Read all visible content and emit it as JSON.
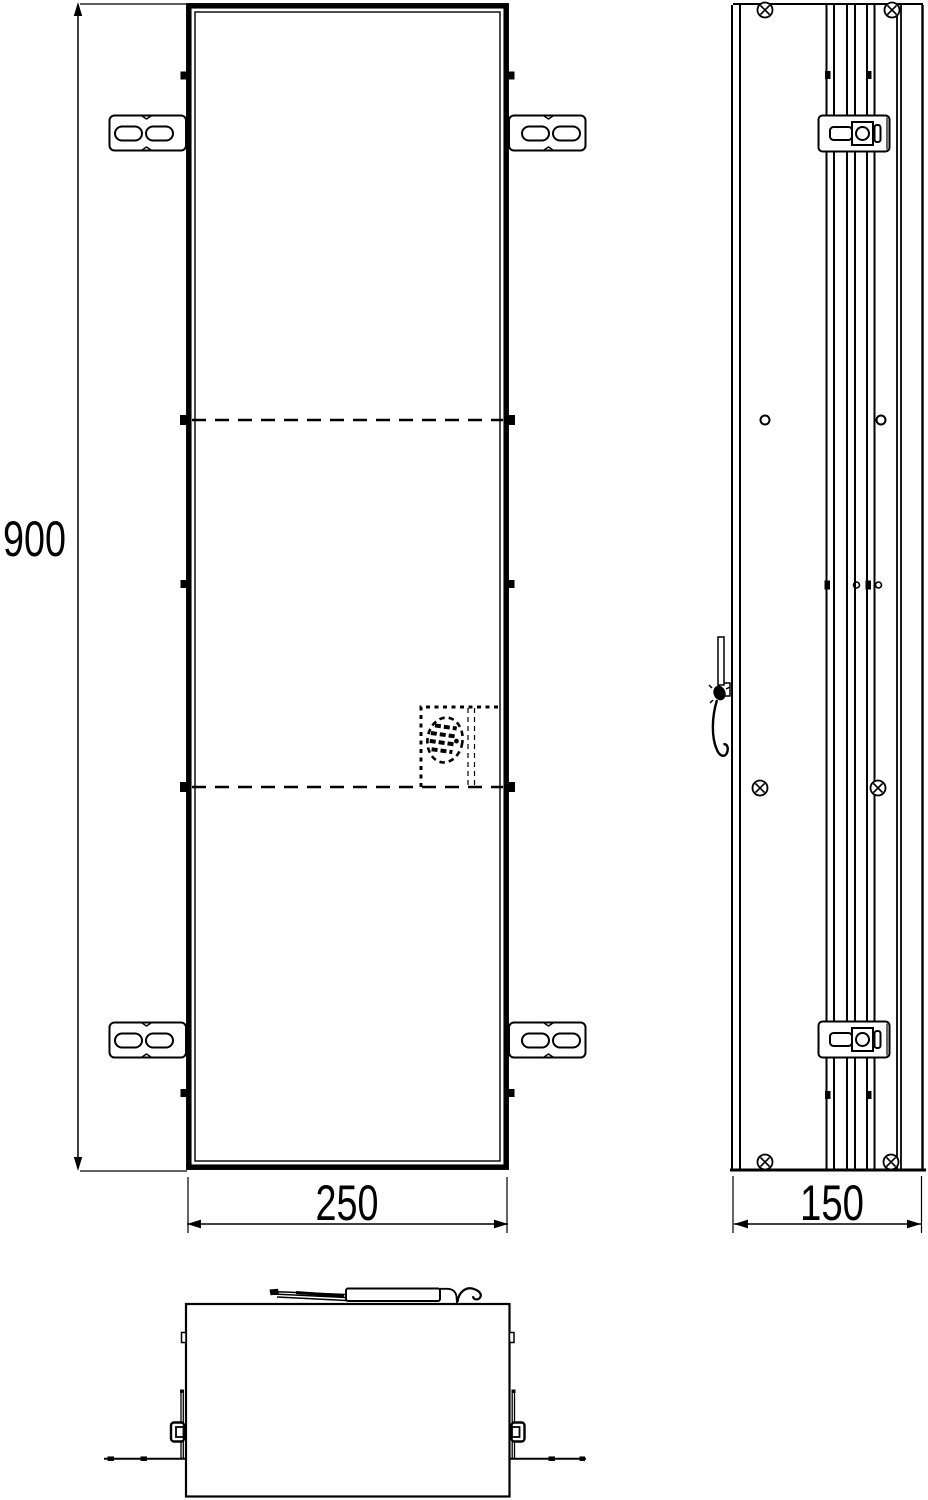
{
  "drawing": {
    "type": "technical-orthographic-drawing",
    "subject": "recessed cabinet module with mounting brackets",
    "background_color": "#ffffff",
    "line_color": "#000000",
    "dimensions": {
      "height": {
        "value": "900"
      },
      "width": {
        "value": "250"
      },
      "depth": {
        "value": "150"
      }
    },
    "icons": {
      "screw": "circle-with-cross",
      "mounting_bracket": "slotted-plate",
      "cable": "hanging-cord",
      "hidden_detail": "dashed-ellipse"
    }
  }
}
